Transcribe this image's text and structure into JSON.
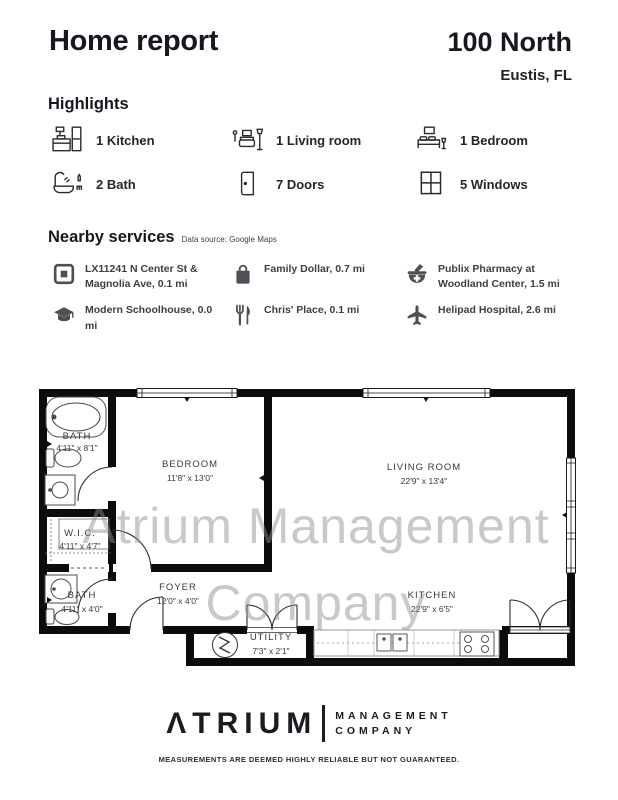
{
  "header": {
    "title": "Home report",
    "property_name": "100 North",
    "property_location": "Eustis, FL"
  },
  "highlights": {
    "heading": "Highlights",
    "items": [
      {
        "icon": "kitchen-icon",
        "label": "1 Kitchen"
      },
      {
        "icon": "living-room-icon",
        "label": "1 Living room"
      },
      {
        "icon": "bedroom-icon",
        "label": "1 Bedroom"
      },
      {
        "icon": "bath-icon",
        "label": "2 Bath"
      },
      {
        "icon": "doors-icon",
        "label": "7 Doors"
      },
      {
        "icon": "windows-icon",
        "label": "5 Windows"
      }
    ]
  },
  "nearby": {
    "heading": "Nearby services",
    "source_note": "Data source: Google Maps",
    "items": [
      {
        "icon": "transit-station-icon",
        "label": "LX11241 N Center St & Magnolia Ave, 0.1 mi"
      },
      {
        "icon": "shopping-bag-icon",
        "label": "Family Dollar, 0.7 mi"
      },
      {
        "icon": "pharmacy-icon",
        "label": "Publix Pharmacy at Woodland Center, 1.5 mi"
      },
      {
        "icon": "school-icon",
        "label": "Modern Schoolhouse, 0.0 mi"
      },
      {
        "icon": "restaurant-icon",
        "label": "Chris' Place, 0.1 mi"
      },
      {
        "icon": "airport-icon",
        "label": "Helipad Hospital, 2.6 mi"
      }
    ]
  },
  "floorplan": {
    "watermark_line1": "Atrium Management",
    "watermark_line2": "Company",
    "rooms": [
      {
        "name": "BATH",
        "dims": "4'11\" x 8'1\""
      },
      {
        "name": "BEDROOM",
        "dims": "11'8\" x 13'0\""
      },
      {
        "name": "LIVING ROOM",
        "dims": "22'9\" x 13'4\""
      },
      {
        "name": "W.I.C.",
        "dims": "4'11\" x 4'7\""
      },
      {
        "name": "BATH",
        "dims": "4'11\" x 4'0\""
      },
      {
        "name": "FOYER",
        "dims": "12'0\" x 4'0\""
      },
      {
        "name": "KITCHEN",
        "dims": "22'9\" x 6'5\""
      },
      {
        "name": "UTILITY",
        "dims": "7'3\" x 2'1\""
      }
    ]
  },
  "footer": {
    "logo_mark": "Λ",
    "logo_rest": "TRIUM",
    "logo_word1": "MANAGEMENT",
    "logo_word2": "COMPANY",
    "disclaimer": "MEASUREMENTS ARE DEEMED HIGHLY RELIABLE BUT NOT GUARANTEED."
  },
  "colors": {
    "text_primary": "#1a1d23",
    "walls": "#0c0c0c",
    "watermark": "#8f8f8f",
    "icon_gray": "#4d5156"
  }
}
